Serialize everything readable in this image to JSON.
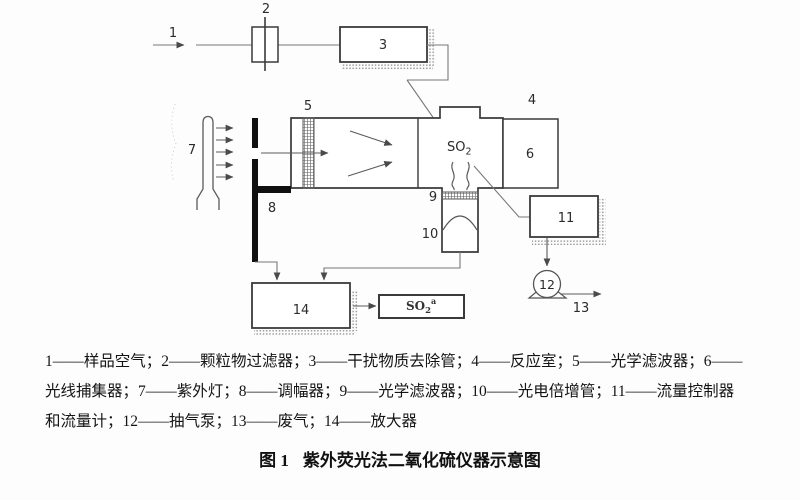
{
  "figure": {
    "legend_line_1": "1——样品空气；2——颗粒物过滤器；3——干扰物质去除管；4——反应室；5——光学滤波器；6——",
    "legend_line_2": "光线捕集器；7——紫外灯；8——调幅器；9——光学滤波器；10——光电倍增管；11——流量控制器",
    "legend_line_3": "和流量计；12——抽气泵；13——废气；14——放大器",
    "caption_prefix": "图 1",
    "caption_title": "紫外荧光法二氧化硫仪器示意图"
  },
  "diagram": {
    "labels": {
      "n1": "1",
      "n2": "2",
      "n3": "3",
      "n4": "4",
      "n5": "5",
      "n6": "6",
      "n7": "7",
      "n8": "8",
      "n9": "9",
      "n10": "10",
      "n11": "11",
      "n12": "12",
      "n13": "13",
      "n14": "14"
    },
    "so2": {
      "base": "SO",
      "sub": "2"
    },
    "so2_output": {
      "base": "SO",
      "sub": "2",
      "sup": "a"
    },
    "colors": {
      "line": "#787878",
      "box_border": "#3a3a3a",
      "modulator_fill": "#101010",
      "hatch": "#9a9a9a",
      "text": "#2b2b2b"
    }
  }
}
